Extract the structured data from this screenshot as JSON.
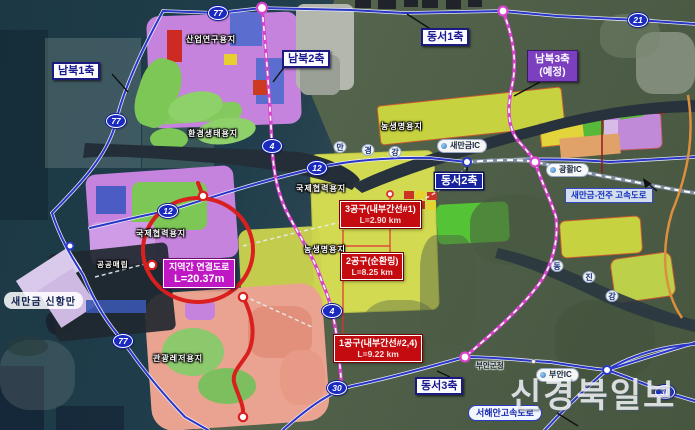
{
  "watermark": "신경북일보",
  "axes": {
    "nb1": "남북1축",
    "nb2": "남북2축",
    "nb3_line1": "남북3축",
    "nb3_line2": "(예정)",
    "ds1": "동서1축",
    "ds2": "동서2축",
    "ds3": "동서3축"
  },
  "badges": {
    "b77": "77",
    "b12": "12",
    "b4": "4",
    "b21": "21",
    "b30": "30"
  },
  "callouts": {
    "regional": {
      "line1": "지역간 연결도로",
      "line2": "L=20.37m"
    },
    "s3": {
      "line1": "3공구(내부간선#1)",
      "line2": "L=2.90 km"
    },
    "s2": {
      "line1": "2공구(순환링)",
      "line2": "L=8.25 km"
    },
    "s1": {
      "line1": "1공구(내부간선#2,4)",
      "line2": "L=9.22 km"
    }
  },
  "ics": {
    "saemangeum": "새만금IC",
    "gwanghwal": "광활IC",
    "buan": "부안IC"
  },
  "highways": {
    "seohaean": "서해안고속도로",
    "saemangeum_jeonju": "새만금-전주 고속도로"
  },
  "zones": {
    "industry": "산업연구용지",
    "eco": "환경생태용지",
    "intl": "국제협력용지",
    "agri": "농생명용지",
    "tourism": "관광레저용지",
    "reclaim": "공공매립",
    "port": "새만금 신항만"
  },
  "places": {
    "buan_office": "부안군청"
  },
  "rivers": {
    "mangyeong": [
      "만",
      "경",
      "강"
    ],
    "dongjin": [
      "동",
      "진",
      "강"
    ]
  },
  "colors": {
    "badge_blue": "#1a2ac0",
    "route_pink": "#d843cc",
    "ring_red": "#da1f1f",
    "callout_red": "#c40b10",
    "callout_magenta": "#bf17c3",
    "axis_navy": "#1a1a90",
    "axis_dark_bg": "#16229e",
    "nb3_purple": "#7b3fc0"
  }
}
